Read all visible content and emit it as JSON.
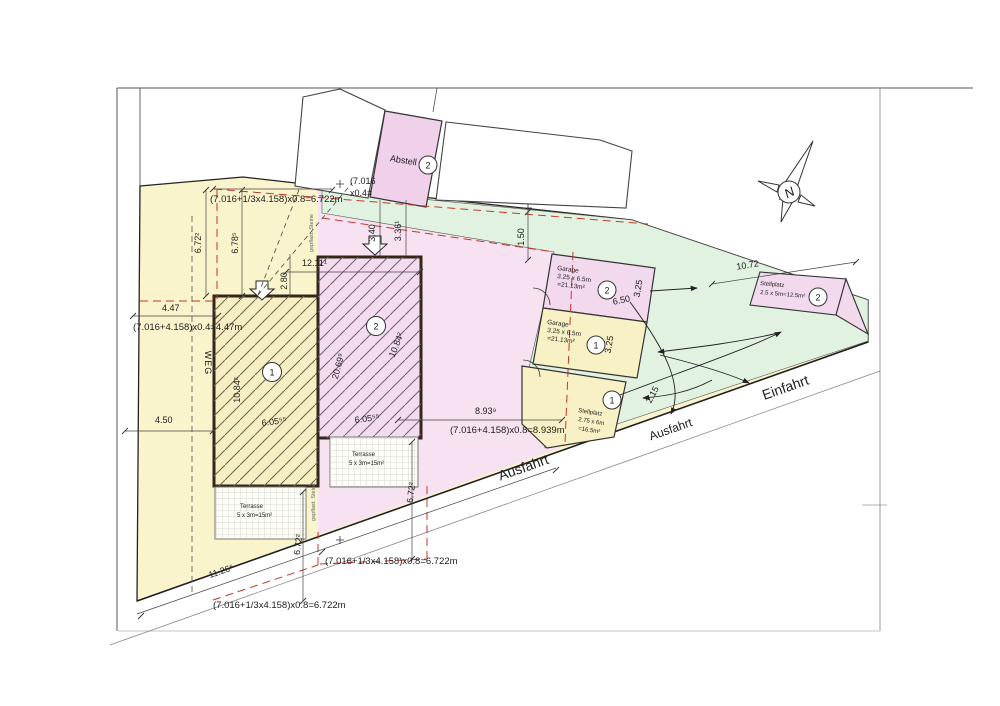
{
  "colors": {
    "parcel_yellow": "#faf4cd",
    "parcel_pink": "#f7e2f2",
    "driveway_green": "#e2f2e0",
    "building_pink": "#f0d0ea",
    "boundary_red": "#c0392b"
  },
  "compass": {
    "north": "N"
  },
  "roads": {
    "einfahrt": "Einfahrt",
    "ausfahrt_upper": "Ausfahrt",
    "ausfahrt_lower": "Ausfahrt",
    "weg": "WEG"
  },
  "notes": {
    "paving_upper": "gepflast. Steine",
    "paving_lower": "gepflast. Steine"
  },
  "areas": {
    "house1": {
      "num": "1"
    },
    "house2": {
      "num": "2"
    },
    "abstell": {
      "label": "Abstell",
      "num": "2"
    },
    "garage2": {
      "label": "Garage",
      "size": "3.25 x 6.5m",
      "area": "=21.13m²",
      "num": "2"
    },
    "garage1": {
      "label": "Garage",
      "size": "3.25 x 6.5m",
      "area": "=21.13m²",
      "num": "1"
    },
    "stellplatz1": {
      "label": "Stellplatz",
      "size": "2.75 x 6m",
      "area": "=16.5m²",
      "num": "1"
    },
    "stellplatz2": {
      "label": "Stellplatz",
      "size": "2.5 x 5m=12.5m²",
      "num": "2"
    },
    "terrace1": {
      "label": "Terrasse",
      "size": "5 x 3m=15m²"
    },
    "terrace2": {
      "label": "Terrasse",
      "size": "5 x 3m=15m²"
    }
  },
  "dims": {
    "f_top": "(7.016+1/3x4.158)x0.8=6.722m",
    "f_bottom1": "(7.016+1/3x4.158)x0.8=6.722m",
    "f_bottom2": "(7.016+1/3x4.158)x0.8=6.722m",
    "f_447": "(7.016+4.158)x0.4=4.47m",
    "f_8939": "(7.016+4.158)x0.8=8.939m",
    "partial_a": "(7.016",
    "partial_b": "x0.4=",
    "v672": "6.72²",
    "v678": "6.78⁵",
    "v280": "2.80",
    "h1211": "12.11¹",
    "v340": "3.40",
    "v336": "3.36¹",
    "v150": "1.50",
    "h447": "4.47",
    "h450": "4.50",
    "b1_height": "10.84²",
    "b1_width": "6.05⁵⁵",
    "b2_height": "20.69⁹",
    "b2_diag": "10.84²",
    "b2_width": "6.05⁵⁵",
    "h893": "8.93⁹",
    "g_650": "6.50",
    "g_325a": "3.25",
    "g_325b": "3.25",
    "g_215": "2.15",
    "s_1072": "10.72",
    "r_1126": "11.26⁶",
    "v672_b1": "6.72²",
    "v672_b2": "6.72²"
  }
}
